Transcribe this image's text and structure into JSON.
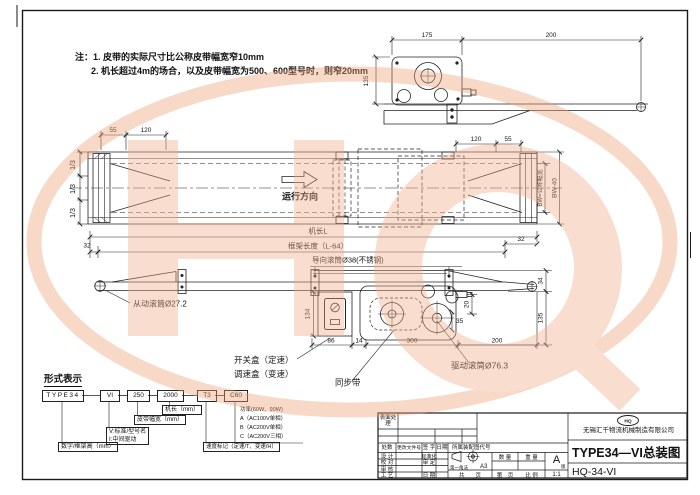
{
  "notes": {
    "line1": "注：1. 皮带的实际尺寸比公称皮带幅宽窄10mm",
    "line2": "2. 机长超过4m的场合，以及皮带幅宽为500、600型号时，则窄20mm"
  },
  "detail": {
    "d175": "175",
    "d200": "200",
    "d135": "135"
  },
  "plan": {
    "d55l": "55",
    "d120l": "120",
    "d120r": "120",
    "d55r": "55",
    "thirds": [
      "1/3",
      "1/3",
      "1/3"
    ],
    "direction": "运行方向",
    "bw_nominal": "BW=公称幅宽",
    "bw_minus": "BW-40"
  },
  "lengths": {
    "machine": "机长L",
    "frame": "框架长度（L-64）",
    "guide": "导向滚筒Ø38(不锈钢)",
    "d32l": "32",
    "d32r": "32",
    "d34": "34",
    "d135": "135"
  },
  "side": {
    "driven": "从动滚筒Ø27.2",
    "d134": "134",
    "d86": "86",
    "d14": "14",
    "d300": "300",
    "d200": "200",
    "d20": "20",
    "d35": "35",
    "switch_box": "开关盒（定速）",
    "speed_box": "调速盒（变速）",
    "sync_belt": "同步带",
    "drive_roller": "驱动滚筒Ø76.3"
  },
  "designation": {
    "title": "形式表示",
    "boxes": [
      "TYPE34",
      "VI",
      "250",
      "2000",
      "T3",
      "C60"
    ],
    "machine_len": "机长（mm）",
    "belt_width": "皮带幅宽（mm）",
    "v_label": "V:标准/型号名",
    "i_label": "I:中间驱动",
    "frame_height": "数字/框架高（mm）",
    "speed_mark": "速度标记（定速/T、变速/H）",
    "power": "功率(60W、90W)",
    "opt_a": "A（AC100V单相）",
    "opt_b": "B（AC200V单相）",
    "opt_c": "C（AC200V三相）"
  },
  "title_block": {
    "surface": "表面处理",
    "qty": "处数",
    "doc": "更改文件号",
    "sign": "签 字",
    "date": "日期",
    "design": "设 计",
    "proof": "校 对",
    "review": "审 核",
    "process": "工 艺",
    "standard": "标准化",
    "approve": "审 定",
    "date2": "日 期",
    "code": "所属装配图代号",
    "quantity": "数 量",
    "weight": "重 量",
    "rev": "A",
    "rev_suffix": "版",
    "first_angle": "第一角法",
    "sheet_size": "A3",
    "total": "共　　页",
    "page": "第　页",
    "scale_label": "比 例",
    "scale": "1:1",
    "logo": "HQ",
    "company": "无锡汇千物流机械制造有限公司",
    "title": "TYPE34—VI总装图",
    "drawing_no": "HQ-34-VI",
    "watermark_color": "#ef9f76"
  },
  "watermark": {
    "text": "HQ"
  }
}
